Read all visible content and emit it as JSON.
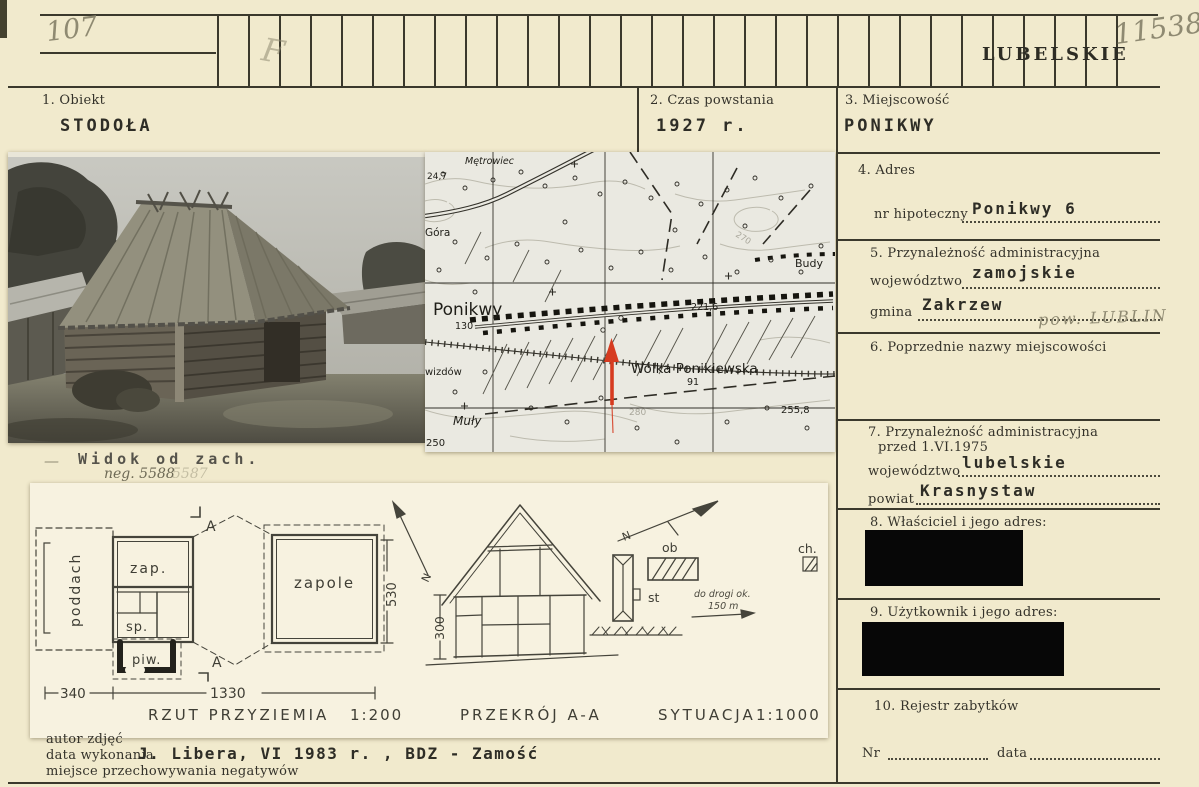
{
  "header": {
    "inventory_no": "107",
    "pencil_mark": "F",
    "region_stamp": "LUBELSKIE",
    "catalog_no": "11538"
  },
  "fields": {
    "obiekt_label": "1. Obiekt",
    "obiekt_value": "STODOŁA",
    "czas_label": "2. Czas powstania",
    "czas_value": "1927 r.",
    "miejscowosc_label": "3. Miejscowość",
    "miejscowosc_value": "PONIKWY",
    "adres_label": "4. Adres",
    "adres_row_label": "nr hipoteczny",
    "adres_value": "Ponikwy 6",
    "przynaleznosc_label": "5. Przynależność administracyjna",
    "wojewodztwo_label": "województwo",
    "wojewodztwo_value": "zamojskie",
    "gmina_label": "gmina",
    "gmina_value": "Zakrzew",
    "gmina_pencil_note": "pow. LUBLIN",
    "poprzednie_label": "6. Poprzednie nazwy miejscowości",
    "przed1975_label": "7. Przynależność administracyjna",
    "przed1975_label2": "przed 1.VI.1975",
    "wojewodztwo2_label": "województwo",
    "wojewodztwo2_value": "lubelskie",
    "powiat_label": "powiat",
    "powiat_value": "Krasnystaw",
    "wlasciciel_label": "8. Właściciel i jego adres:",
    "uzytkownik_label": "9. Użytkownik i jego adres:",
    "rejestr_label": "10. Rejestr zabytków",
    "nr_label": "Nr",
    "data_label": "data"
  },
  "photo": {
    "caption_dash": "—",
    "caption": "Widok od zach.",
    "negative_note": "neg. 5588",
    "negative_note2": "5587"
  },
  "map": {
    "metrowiec": "Mętrowiec",
    "elev_247": "24,7",
    "gora": "Góra",
    "ponikwy": "Ponikwy",
    "num_130": "130",
    "budy": "Budy",
    "contour_270": "270",
    "elev_2216": "221,6",
    "wolka": "Wólka Ponikiewska",
    "num_91": "91",
    "wizdow": "wizdów",
    "muly": "Muły",
    "contour_280": "280",
    "elev_2558": "255,8",
    "num_250": "250"
  },
  "drawing": {
    "room_poddach": "poddach",
    "room_zap": "zap.",
    "room_sp": "sp.",
    "room_piw": "piw.",
    "room_zapole": "zapole",
    "dim_340": "340",
    "dim_1330": "1330",
    "dim_530": "530",
    "dim_300": "300",
    "section_a": "A",
    "north": "N",
    "plan_caption": "RZUT PRZYZIEMIA",
    "plan_scale": "1:200",
    "section_caption": "PRZEKRÓJ A-A",
    "situation_caption": "SYTUACJA",
    "situation_scale": "1:1000",
    "sit_ob": "ob",
    "sit_st": "st",
    "sit_ch": "ch.",
    "sit_note1": "do drogi ok.",
    "sit_note2": "150 m"
  },
  "footer": {
    "author_label": "autor zdjęć",
    "date_label": "data wykonania",
    "date_value": "J. Libera, VI 1983 r. , BDZ - Zamość",
    "storage_label": "miejsce przechowywania negatywów"
  },
  "colors": {
    "card": "#f1eacd",
    "ink": "#3b392c",
    "pencil": "#8f8a72",
    "arrow_red": "#d63b20"
  }
}
